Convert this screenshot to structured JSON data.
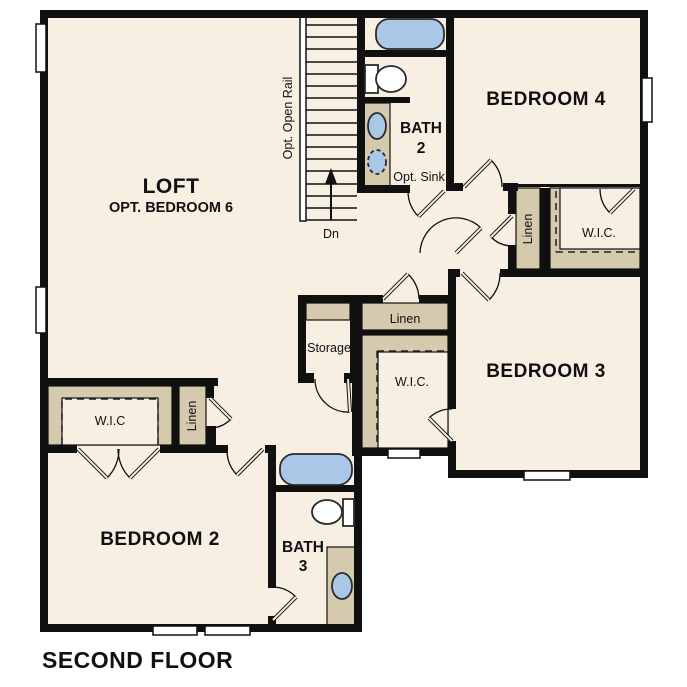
{
  "plan_title": "SECOND FLOOR",
  "rooms": {
    "loft": {
      "label": "LOFT",
      "sublabel": "OPT. BEDROOM 6"
    },
    "bedroom2": {
      "label": "BEDROOM 2"
    },
    "bedroom3": {
      "label": "BEDROOM 3"
    },
    "bedroom4": {
      "label": "BEDROOM 4"
    },
    "bath2": {
      "label_line1": "BATH",
      "label_line2": "2",
      "note": "Opt. Sink"
    },
    "bath3": {
      "label_line1": "BATH",
      "label_line2": "3"
    },
    "storage": {
      "label": "Storage"
    }
  },
  "closets": {
    "wic_bedroom2": {
      "label": "W.I.C"
    },
    "wic_bedroom3": {
      "label": "W.I.C."
    },
    "wic_bedroom4": {
      "label": "W.I.C."
    },
    "linen_hall_left": {
      "label": "Linen"
    },
    "linen_hall_center": {
      "label": "Linen"
    },
    "linen_hall_right": {
      "label": "Linen"
    }
  },
  "stairs": {
    "rail_label": "Opt. Open Rail",
    "down_label": "Dn"
  },
  "colors": {
    "floor": "#f6efe2",
    "closet_shelf": "#d5c9ae",
    "wall": "#101010",
    "fixture_blue": "#a9c8e7",
    "window_white": "#ffffff",
    "text": "#111111"
  }
}
